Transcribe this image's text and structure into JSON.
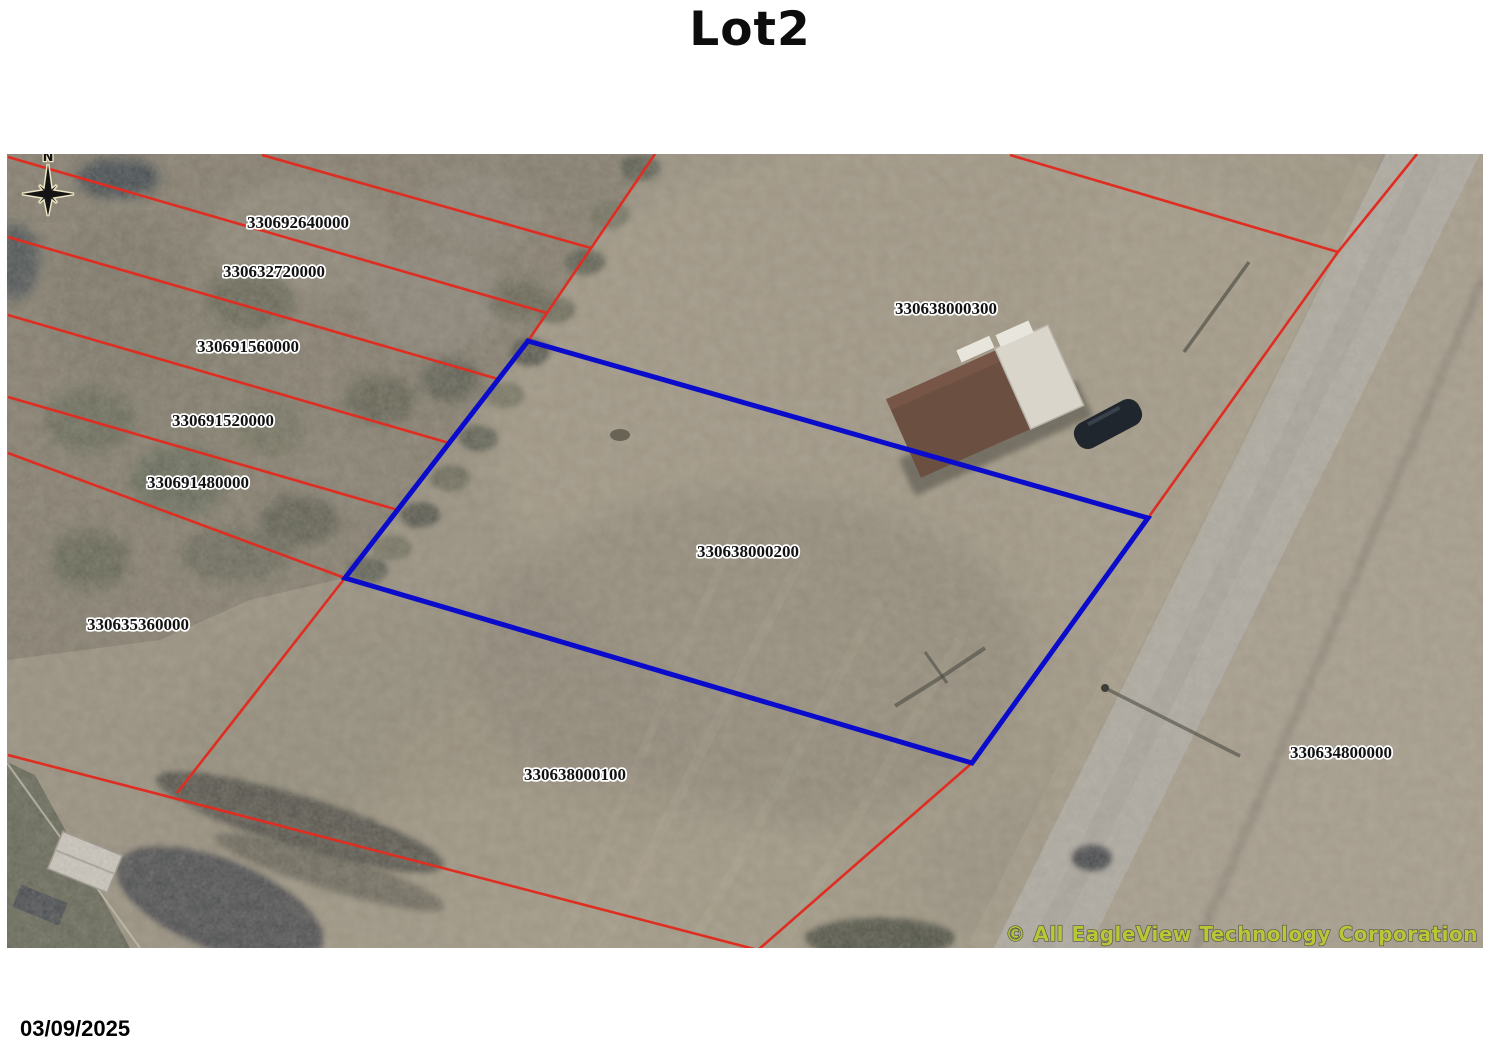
{
  "page": {
    "title": "Lot2",
    "date": "03/09/2025"
  },
  "map": {
    "north_label": "N",
    "copyright": "© All EagleView Technology Corporation",
    "highlighted_parcel_id": "330638000200",
    "colors": {
      "parcel_line": "#df2d22",
      "highlight_line": "#0b0bcb",
      "copyright_text": "#b9c636",
      "label_text": "#111111",
      "label_halo": "#ffffff"
    },
    "parcel_labels": [
      {
        "id": "330692640000"
      },
      {
        "id": "330632720000"
      },
      {
        "id": "330691560000"
      },
      {
        "id": "330691520000"
      },
      {
        "id": "330691480000"
      },
      {
        "id": "330635360000"
      },
      {
        "id": "330638000300"
      },
      {
        "id": "330638000200"
      },
      {
        "id": "330638000100"
      },
      {
        "id": "330634800000"
      }
    ]
  }
}
